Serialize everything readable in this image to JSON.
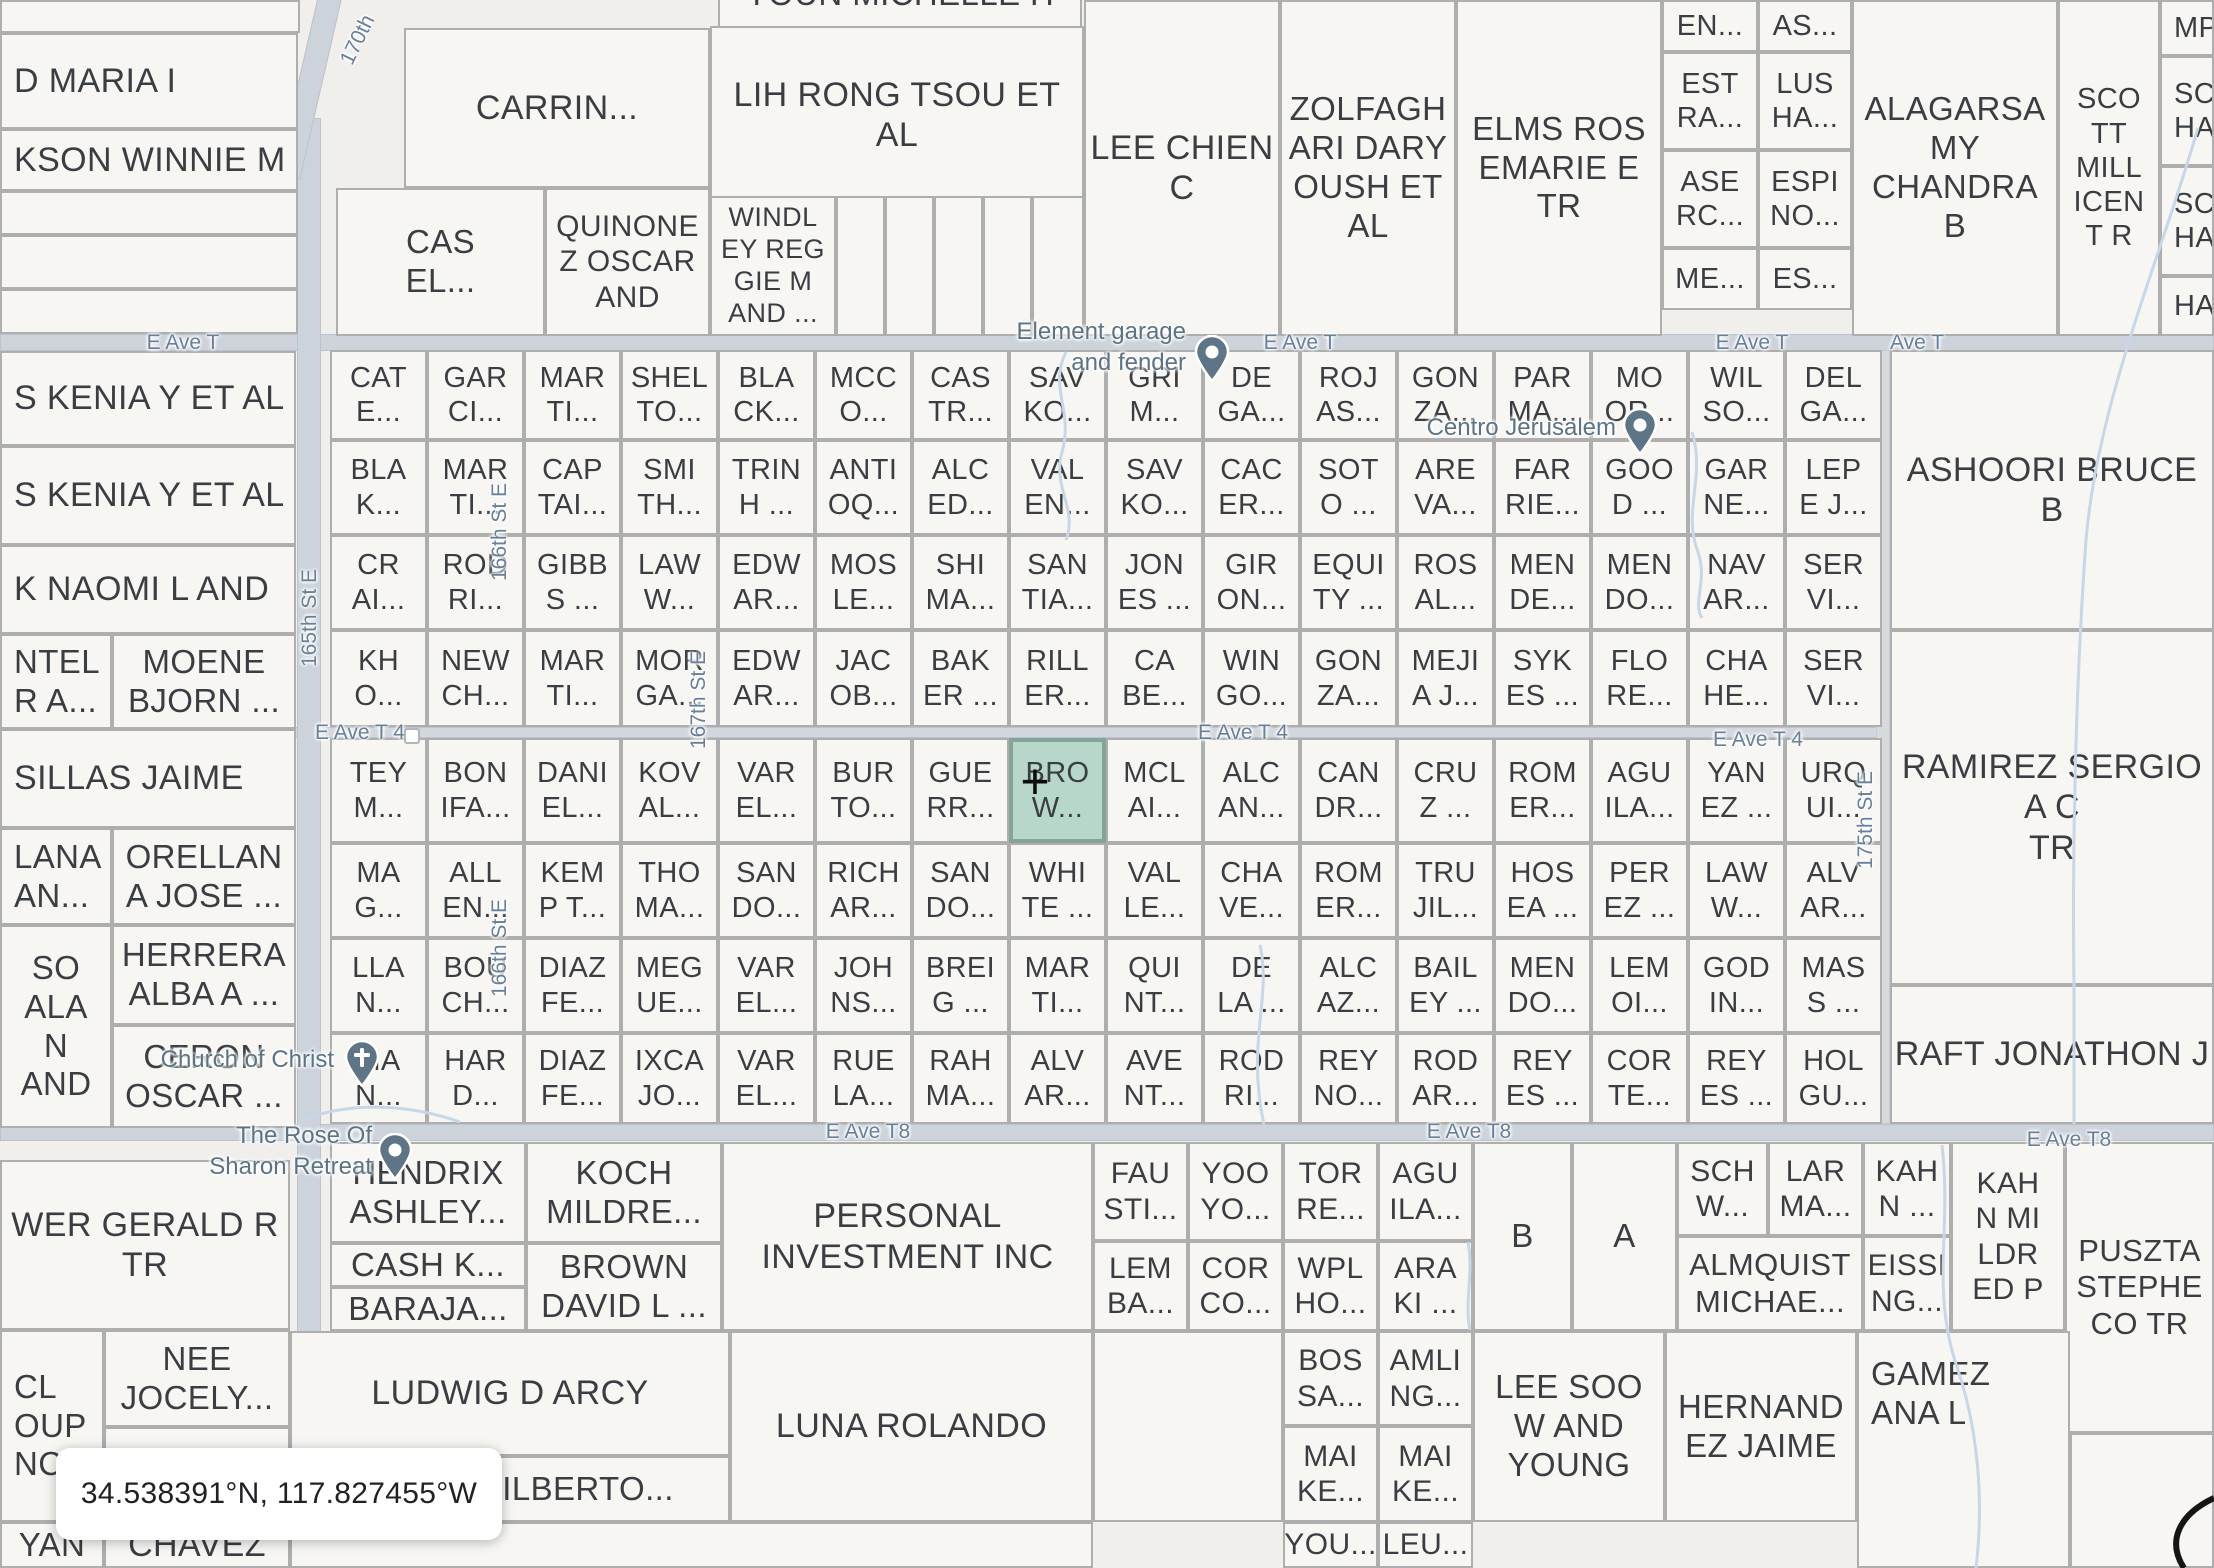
{
  "coordinates_box": "34.538391°N, 117.827455°W",
  "highlight": {
    "row": 4,
    "col": 7,
    "crosshair": "+"
  },
  "pois": {
    "element_garage": {
      "label": "Element garage\nand fender"
    },
    "centro_jerusalem": {
      "label": "Centro Jerusalem"
    },
    "church_of_christ": {
      "label": "Church of Christ"
    },
    "rose_of_sharon": {
      "label": "The Rose Of\nSharon Retreat"
    }
  },
  "streets": {
    "e_ave_t": [
      "E Ave T",
      "E Ave T",
      "E Ave T",
      "Ave T"
    ],
    "e_ave_t4": [
      "E Ave T 4",
      "E Ave T 4",
      "E Ave T 4"
    ],
    "e_ave_t8": [
      "E Ave T8",
      "E Ave T8",
      "E Ave T8"
    ],
    "vertical": [
      "165th St E",
      "166th St E",
      "166th St E",
      "167th St E",
      "175th St E",
      "170th"
    ]
  },
  "grid_rows": [
    [
      "CAT\nE...",
      "GAR\nCI...",
      "MAR\nTI...",
      "SHEL\nTO...",
      "BLA\nCK...",
      "MCC\nO...",
      "CAS\nTR...",
      "SAV\nKO...",
      "GRI\nM...",
      "DE\nGA...",
      "ROJ\nAS...",
      "GON\nZA...",
      "PAR\nMA...",
      "MO\nOR...",
      "WIL\nSO...",
      "DEL\nGA..."
    ],
    [
      "BLA\nK...",
      "MAR\nTI...",
      "CAP\nTAI...",
      "SMI\nTH...",
      "TRIN\nH ...",
      "ANTI\nOQ...",
      "ALC\nED...",
      "VAL\nEN...",
      "SAV\nKO...",
      "CAC\nER...",
      "SOT\nO ...",
      "ARE\nVA...",
      "FAR\nRIE...",
      "GOO\nD ...",
      "GAR\nNE...",
      "LEP\nE J..."
    ],
    [
      "CR\nAI...",
      "ROD\nRI...",
      "GIBB\nS ...",
      "LAW\nW...",
      "EDW\nAR...",
      "MOS\nLE...",
      "SHI\nMA...",
      "SAN\nTIA...",
      "JON\nES ...",
      "GIR\nON...",
      "EQUI\nTY ...",
      "ROS\nAL...",
      "MEN\nDE...",
      "MEN\nDO...",
      "NAV\nAR...",
      "SER\nVI..."
    ],
    [
      "KH\nO...",
      "NEW\nCH...",
      "MAR\nTI...",
      "MOR\nGA...",
      "EDW\nAR...",
      "JAC\nOB...",
      "BAK\nER ...",
      "RILL\nER...",
      "CA\nBE...",
      "WIN\nGO...",
      "GON\nZA...",
      "MEJI\nA J...",
      "SYK\nES ...",
      "FLO\nRE...",
      "CHA\nHE...",
      "SER\nVI..."
    ],
    [
      "TEY\nM...",
      "BON\nIFA...",
      "DANI\nEL...",
      "KOV\nAL...",
      "VAR\nEL...",
      "BUR\nTO...",
      "GUE\nRR...",
      "BRO\nW...",
      "MCL\nAI...",
      "ALC\nAN...",
      "CAN\nDR...",
      "CRU\nZ ...",
      "ROM\nER...",
      "AGU\nILA...",
      "YAN\nEZ ...",
      "URQ\nUI..."
    ],
    [
      "MA\nG...",
      "ALL\nEN...",
      "KEM\nP T...",
      "THO\nMA...",
      "SAN\nDO...",
      "RICH\nAR...",
      "SAN\nDO...",
      "WHI\nTE ...",
      "VAL\nLE...",
      "CHA\nVE...",
      "ROM\nER...",
      "TRU\nJIL...",
      "HOS\nEA ...",
      "PER\nEZ ...",
      "LAW\nW...",
      "ALV\nAR..."
    ],
    [
      "LLA\nN...",
      "BOU\nCH...",
      "DIAZ\nFE...",
      "MEG\nUE...",
      "VAR\nEL...",
      "JOH\nNS...",
      "BREI\nG ...",
      "MAR\nTI...",
      "QUI\nNT...",
      "DE\nLA ...",
      "ALC\nAZ...",
      "BAIL\nEY ...",
      "MEN\nDO...",
      "LEM\nOI...",
      "GOD\nIN...",
      "MAS\nS ..."
    ],
    [
      "MA\nN...",
      "HAR\nD...",
      "DIAZ\nFE...",
      "IXCA\nJO...",
      "VAR\nEL...",
      "RUE\nLA...",
      "RAH\nMA...",
      "ALV\nAR...",
      "AVE\nNT...",
      "ROD\nRI...",
      "REY\nNO...",
      "ROD\nAR...",
      "REY\nES ...",
      "COR\nTE...",
      "REY\nES ...",
      "HOL\nGU..."
    ]
  ],
  "parcels": {
    "p_toun": "YOUN MICHELLE H",
    "p_carrin": "CARRIN...",
    "p_lih": "LIH RONG TSOU ET\nAL",
    "p_windley": "WINDL\nEY REG\nGIE M\nAND ...",
    "p_cas": "CAS\nEL...",
    "p_quinonez": "QUINONE\nZ OSCAR\nAND",
    "p_lee": "LEE CHIEN\nC",
    "p_zolf": "ZOLFAGH\nARI DARY\nOUSH ET\nAL",
    "p_elms": "ELMS ROS\nEMARIE E\nTR",
    "p_en": "EN...",
    "p_as": "AS...",
    "p_estra": "EST\nRA...",
    "p_lusha": "LUS\nHA...",
    "p_aserc": "ASE\nRC...",
    "p_espino": "ESPI\nNO...",
    "p_me": "ME...",
    "p_es": "ES...",
    "p_alagarsamy": "ALAGARSA\nMY\nCHANDRA\nB",
    "p_scott": "SCO\nTT\nMILL\nICEN\nT R",
    "p_mp": "MP...",
    "p_scha1": "SC\nHA...",
    "p_scha2": "SC\nHA...",
    "p_ha": "HA...",
    "p_dmaria": "D MARIA I",
    "p_kson": "KSON WINNIE M",
    "p_oskenia1": "S KENIA Y ET AL",
    "p_oskenia2": "S KENIA Y ET AL",
    "p_knaomi": "K NAOMI L AND",
    "p_ntel": "NTEL\nR A...",
    "p_moene": "MOENE\nBJORN ...",
    "p_sillas": "SILLAS JAIME",
    "p_lana": "LANA\nAN...",
    "p_orellana": "ORELLAN\nA JOSE ...",
    "p_soalan": "SO\nALA\nN\nAND",
    "p_herrera": "HERRERA\nALBA A ...",
    "p_ceron": "CERON\nOSCAR ...",
    "p_wer": "WER GERALD R\nTR",
    "p_cl": "CL\nOUP\nNC",
    "p_nee": "NEE\nJOCELY...",
    "p_vernon": "VERNON...",
    "p_yan": "YAN",
    "p_chavez": "CHAVEZ",
    "p_hendrix": "HENDRIX\nASHLEY...",
    "p_cash": "CASH K...",
    "p_baraja": "BARAJA...",
    "p_koch": "KOCH\nMILDRE...",
    "p_brown": "BROWN\nDAVID L ...",
    "p_personal": "PERSONAL\nINVESTMENT INC",
    "p_fau": "FAU\nSTI...",
    "p_lem2": "LEM\nBA...",
    "p_yoo": "YOO\nYO...",
    "p_corco": "COR\nCO...",
    "p_tor": "TOR\nRE...",
    "p_wpl": "WPL\nHO...",
    "p_agu2": "AGU\nILA...",
    "p_ara": "ARA\nKI ...",
    "p_b": "B",
    "p_a": "A",
    "p_schw": "SCH\nW...",
    "p_lar": "LAR\nMA...",
    "p_kahn1": "KAH\nN ...",
    "p_kahn2": "KAH\nN MI\nLDR\nED P",
    "p_almquist": "ALMQUIST\nMICHAE...",
    "p_eissing": "EISSI\nNG...",
    "p_pusztai": "PUSZTA\nSTEPHE\nCO TR",
    "p_ludwig": "LUDWIG D ARCY",
    "p_gilberto": "GILBERTO...",
    "p_luna": "LUNA ROLANDO",
    "p_bos": "BOS\nSA...",
    "p_amli": "AMLI\nNG...",
    "p_mai1": "MAI\nKE...",
    "p_mai2": "MAI\nKE...",
    "p_you": "YOU...",
    "p_leu": "LEU...",
    "p_leesoo": "LEE SOO\nW AND\nYOUNG",
    "p_hernandez": "HERNAND\nEZ JAIME",
    "p_gamez": "GAMEZ\nANA L",
    "p_ashoori": "ASHOORI BRUCE B",
    "p_ramirez": "RAMIREZ SERGIO A C\nTR",
    "p_raft": "RAFT JONATHON J"
  }
}
